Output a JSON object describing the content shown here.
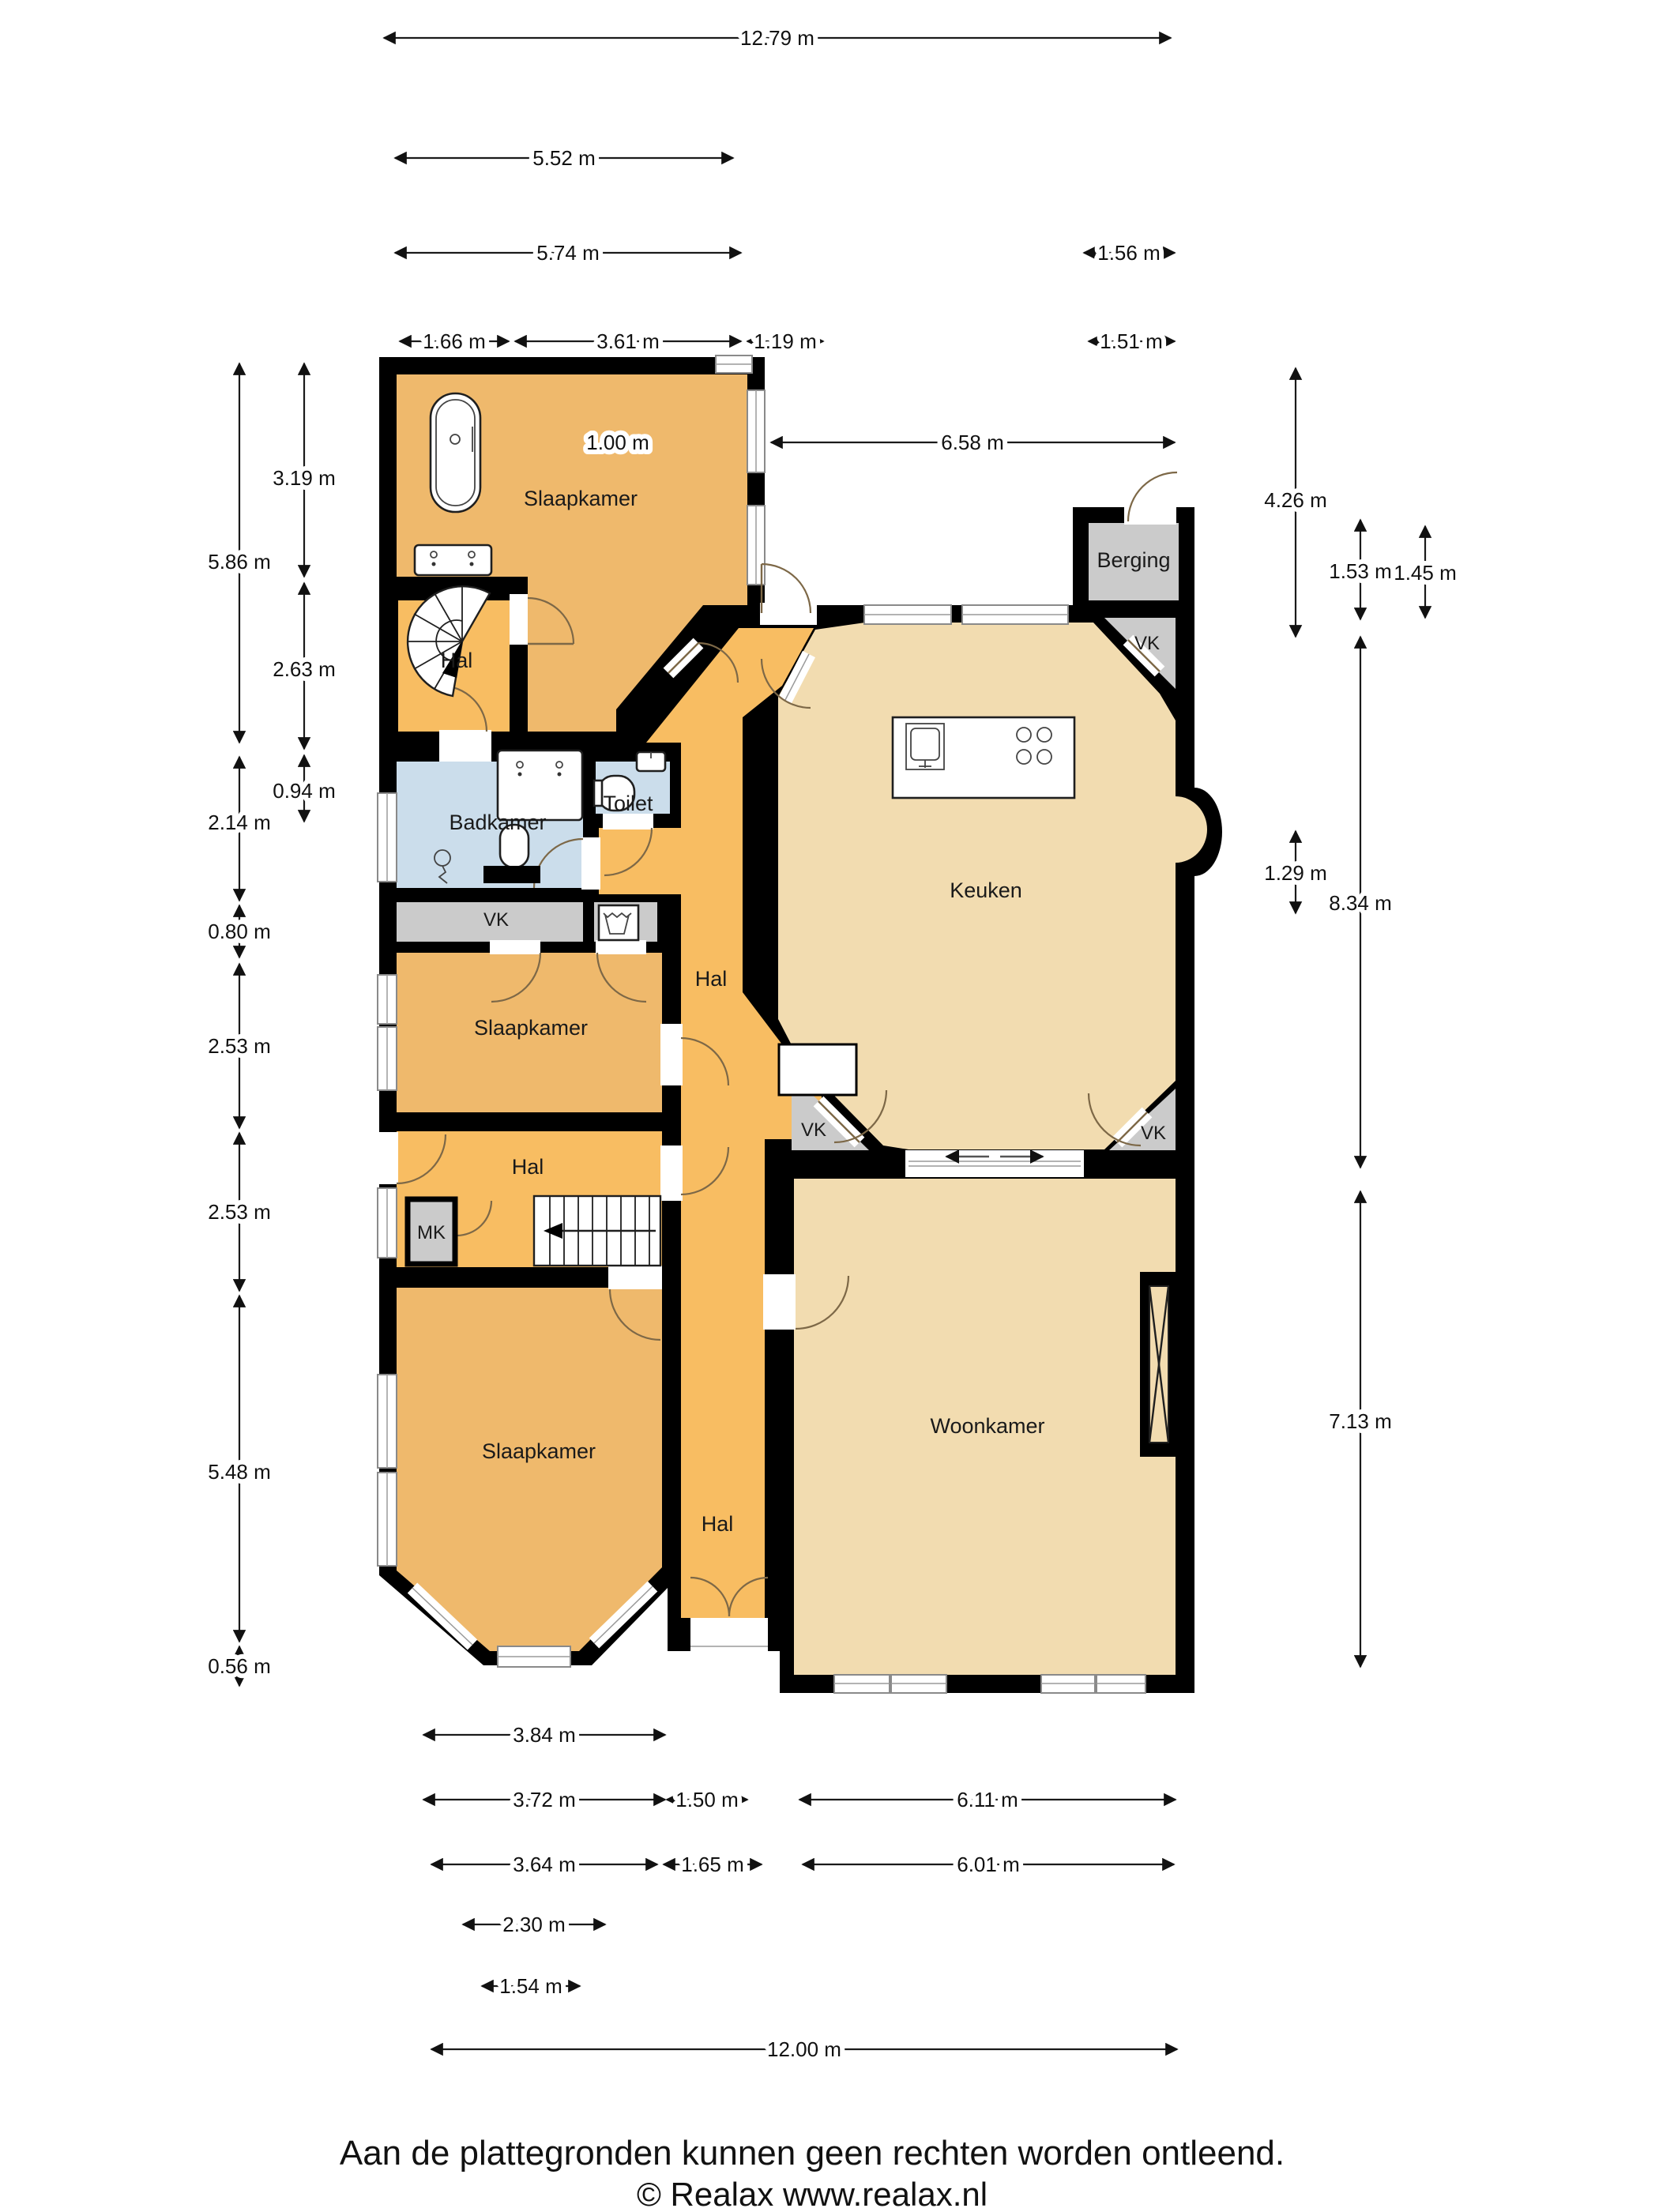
{
  "rooms": [
    {
      "id": "slaapkamer-top",
      "label": "Slaapkamer"
    },
    {
      "id": "hal-top",
      "label": "Hal"
    },
    {
      "id": "badkamer",
      "label": "Badkamer"
    },
    {
      "id": "toilet",
      "label": "Toilet"
    },
    {
      "id": "vk-strip",
      "label": "VK"
    },
    {
      "id": "slaapkamer-mid",
      "label": "Slaapkamer"
    },
    {
      "id": "hal-center",
      "label": "Hal"
    },
    {
      "id": "hal-mid",
      "label": "Hal"
    },
    {
      "id": "mk",
      "label": "MK"
    },
    {
      "id": "slaapkamer-bottom",
      "label": "Slaapkamer"
    },
    {
      "id": "hal-bottom",
      "label": "Hal"
    },
    {
      "id": "woonkamer",
      "label": "Woonkamer"
    },
    {
      "id": "keuken",
      "label": "Keuken"
    },
    {
      "id": "berging",
      "label": "Berging"
    },
    {
      "id": "vk-topright",
      "label": "VK"
    },
    {
      "id": "vk-bottomleft",
      "label": "VK"
    },
    {
      "id": "vk-bottomright",
      "label": "VK"
    }
  ],
  "dims": {
    "top": [
      {
        "label": "12.79 m"
      },
      {
        "label": "5.52 m"
      },
      {
        "label": "5.74 m"
      },
      {
        "label": "1.56 m"
      },
      {
        "label": "1.66 m"
      },
      {
        "label": "3.61 m"
      },
      {
        "label": "1.19 m"
      },
      {
        "label": "1.51 m"
      },
      {
        "label": "1.00 m"
      },
      {
        "label": "6.58 m"
      }
    ],
    "left": [
      {
        "label": "5.86 m"
      },
      {
        "label": "2.14 m"
      },
      {
        "label": "0.80 m"
      },
      {
        "label": "2.53 m"
      },
      {
        "label": "2.53 m"
      },
      {
        "label": "5.48 m"
      },
      {
        "label": "0.56 m"
      },
      {
        "label": "3.19 m"
      },
      {
        "label": "2.63 m"
      },
      {
        "label": "0.94 m"
      }
    ],
    "right": [
      {
        "label": "4.26 m"
      },
      {
        "label": "1.53 m"
      },
      {
        "label": "1.45 m"
      },
      {
        "label": "1.29 m"
      },
      {
        "label": "8.34 m"
      },
      {
        "label": "7.13 m"
      }
    ],
    "bottom": [
      {
        "label": "3.84 m"
      },
      {
        "label": "3.72 m"
      },
      {
        "label": "1.50 m"
      },
      {
        "label": "6.11 m"
      },
      {
        "label": "3.64 m"
      },
      {
        "label": "1.65 m"
      },
      {
        "label": "6.01 m"
      },
      {
        "label": "2.30 m"
      },
      {
        "label": "1.54 m"
      },
      {
        "label": "12.00 m"
      }
    ]
  },
  "footer": {
    "disclaimer": "Aan de plattegronden kunnen geen rechten worden ontleend.",
    "copyright": "© Realax www.realax.nl"
  },
  "colors": {
    "wall": "#000000",
    "bedroom": "#EFB96C",
    "hall": "#F8BD62",
    "living": "#F2DCB0",
    "bathroom": "#CBDDEB",
    "closet": "#CBCBCB"
  }
}
